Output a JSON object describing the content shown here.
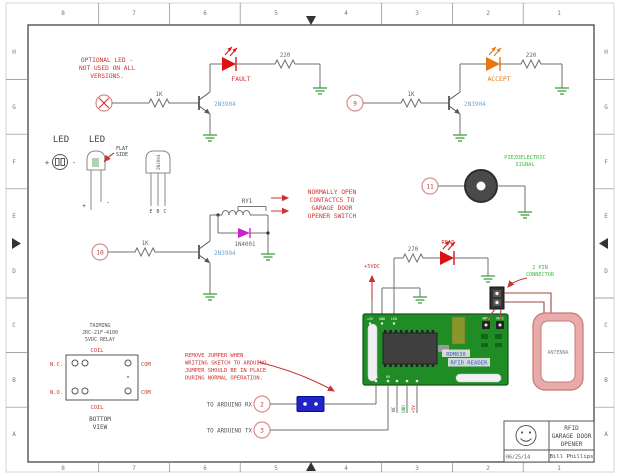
{
  "border": {
    "columns": [
      "8",
      "7",
      "6",
      "5",
      "4",
      "3",
      "2",
      "1"
    ],
    "rows": [
      "H",
      "G",
      "F",
      "E",
      "D",
      "C",
      "B",
      "A"
    ]
  },
  "title_block": {
    "title_lines": [
      "RFID",
      "GARAGE DOOR",
      "OPENER"
    ],
    "author": "Bill Phillips",
    "date": "06/25/14",
    "logo": "smiley-face-icon"
  },
  "legend": {
    "led_top_label": "LED",
    "led_side_label": "LED",
    "flat_side": [
      "FLAT",
      "SIDE"
    ],
    "led_top_plus": "+",
    "led_top_minus": "-",
    "led_side_plus": "+",
    "led_side_minus": "-",
    "package_name": "2N3904",
    "package_pins": [
      "E",
      "B",
      "C"
    ]
  },
  "fault_circuit": {
    "note_lines": [
      "OPTIONAL LED -",
      "NOT USED ON ALL",
      "VERSIONS."
    ],
    "pin_icon": "crossed-circle",
    "base_resistor": "1K",
    "transistor": "2N3904",
    "led_name": "FAULT",
    "series_resistor": "220"
  },
  "accept_circuit": {
    "pin": "9",
    "base_resistor": "1K",
    "transistor": "2N3904",
    "led_name": "ACCEPT",
    "series_resistor": "220"
  },
  "relay_circuit": {
    "pin": "10",
    "base_resistor": "1K",
    "transistor": "2N3904",
    "relay_ref": "RY1",
    "flyback_diode": "1N4001",
    "note_lines": [
      "NORMALLY OPEN",
      "CONTACTCS TO",
      "GARAGE DOOR",
      "OPENER SWITCH"
    ]
  },
  "piezo_circuit": {
    "pin": "11",
    "note_lines": [
      "PIEZOELECTRIC",
      "SIGNAL"
    ]
  },
  "reader": {
    "supply": "+5VDC",
    "led_resistor": "270",
    "led_name": "READ",
    "connector_note_lines": [
      "2 PIN",
      "CONNECTOR"
    ],
    "antenna_label": "ANTENNA",
    "board_silk_lines": [
      "RDM630",
      "RFID READER"
    ],
    "top_pin_labels": [
      "+5V",
      "GND",
      "LED"
    ],
    "ant_pin_labels": [
      "ANT1",
      "ANT2"
    ],
    "bottom_pin_labels": [
      "TX",
      "RX"
    ],
    "stub_pin_labels": [
      "NC",
      "GND",
      "+5V"
    ]
  },
  "arduino": {
    "rx_label": "TO ARDUINO RX",
    "rx_pin": "2",
    "tx_label": "TO ARDUINO TX",
    "tx_pin": "3",
    "jumper_note_lines": [
      "REMOVE JUMPER WHEN",
      "WRITING SKETCH TO ARDUINO.",
      "JUMPER SHOULD BE IN PLACE",
      "DURING NORMAL OPERATION."
    ]
  },
  "relay_view": {
    "part_lines": [
      "TAIMING",
      "JRC-21F-4100",
      "5VDC RELAY"
    ],
    "coil_top": "COIL",
    "coil_bottom": "COIL",
    "nc": "N.C.",
    "no": "N.O.",
    "com_top": "COM",
    "com_bottom": "COM",
    "caption_lines": [
      "BOTTOM",
      "VIEW"
    ]
  },
  "colors": {
    "annotation_red": "#cc3333",
    "annotation_green": "#3fba3f",
    "device_blue": "#6fa8d0",
    "wire_gray": "#6f6f6f",
    "ground_green": "#2e9b2e",
    "led_red": "#dd1111",
    "led_orange": "#e87511",
    "diode_magenta": "#cc22cc",
    "board_green": "#1f8c25",
    "antenna_pink": "#e9aaaa",
    "jumper_blue": "#2323c8"
  }
}
